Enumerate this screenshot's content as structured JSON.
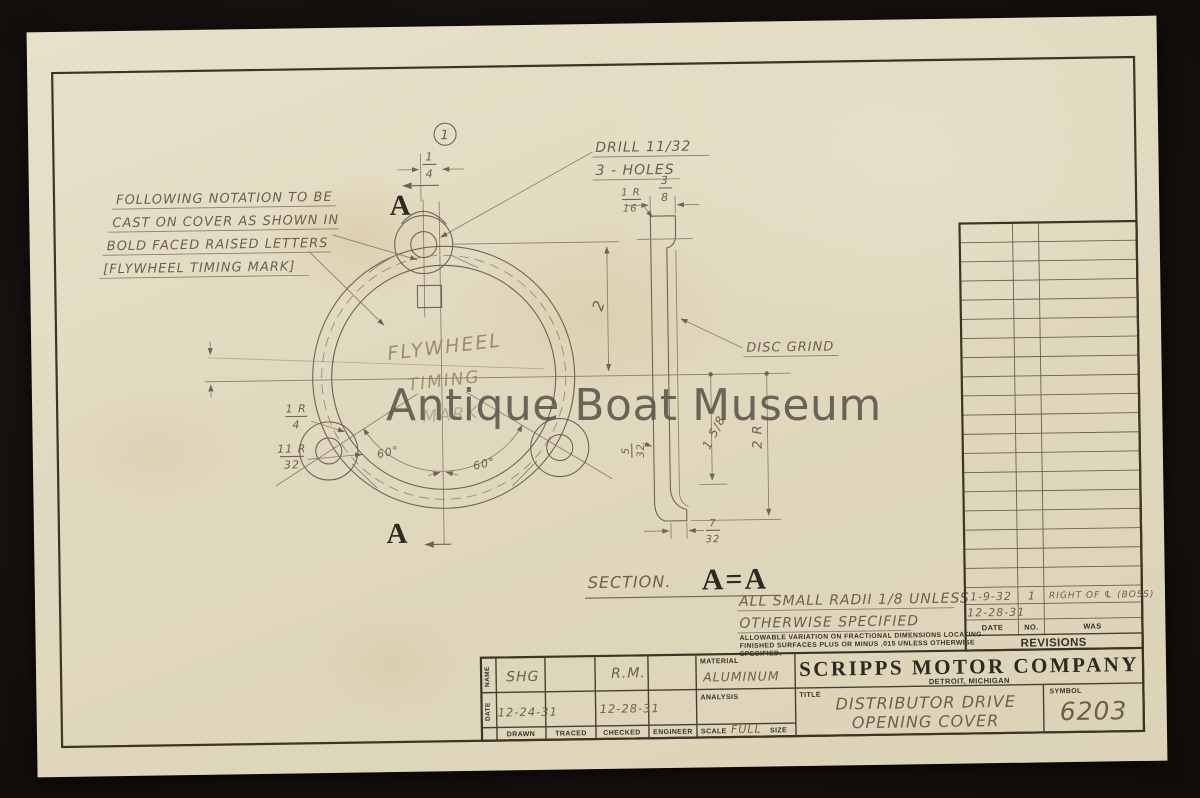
{
  "watermark": {
    "text": "Antique Boat Museum"
  },
  "sheet": {
    "detail_marker": "1",
    "cast_note": {
      "line1": "FOLLOWING NOTATION TO BE",
      "line2": "CAST ON COVER AS SHOWN IN",
      "line3": "BOLD FACED RAISED LETTERS",
      "line4": "[FLYWHEEL TIMING MARK]"
    },
    "drill_note": {
      "line1": "DRILL 11/32",
      "line2": "3 - HOLES"
    },
    "cast_text": {
      "line1": "FLYWHEEL",
      "line2": "TIMING",
      "line3": "MARK"
    },
    "disc_grind": "DISC GRIND",
    "section_arrow_top": "A",
    "section_arrow_bottom": "A",
    "section_label": {
      "prefix": "SECTION.",
      "letters": "A=A"
    },
    "radii_note": {
      "line1": "ALL SMALL RADII 1/8 UNLESS",
      "line2": "OTHERWISE SPECIFIED"
    },
    "variation_note": {
      "line1": "ALLOWABLE VARIATION ON FRACTIONAL DIMENSIONS LOCATING",
      "line2": "FINISHED SURFACES PLUS OR MINUS .015 UNLESS OTHERWISE",
      "line3": "SPECIFIED."
    },
    "dims": {
      "hole_offset": {
        "n": "1",
        "d": "4"
      },
      "center_to_hole": "2",
      "flange_width": {
        "n": "3",
        "d": "8"
      },
      "flange_radius": {
        "n": "1 R",
        "d": "16"
      },
      "lug_fillet_radius": {
        "n": "1 R",
        "d": "4"
      },
      "lug_radius": {
        "n": "11 R",
        "d": "32"
      },
      "wall_thickness": {
        "n": "5",
        "d": "32"
      },
      "foot_width": {
        "n": "7",
        "d": "32"
      },
      "inner_depth": "1 5/8",
      "outer_radius": "2 R",
      "angle_left": "60°",
      "angle_right": "60°"
    }
  },
  "revisions": {
    "title": "REVISIONS",
    "columns": {
      "date": "DATE",
      "no": "NO.",
      "was": "WAS"
    },
    "entries": [
      {
        "date": "1-9-32",
        "no": "1",
        "was": "RIGHT OF ℄ (BOSS)"
      },
      {
        "date": "12-28-31",
        "no": "",
        "was": ""
      }
    ],
    "empty_row_count": 19
  },
  "title_block": {
    "company": "SCRIPPS MOTOR COMPANY",
    "location": "DETROIT, MICHIGAN",
    "labels": {
      "name": "NAME",
      "date": "DATE",
      "drawn": "DRAWN",
      "traced": "TRACED",
      "checked": "CHECKED",
      "engineer": "ENGINEER",
      "material": "MATERIAL",
      "analysis": "ANALYSIS",
      "scale": "SCALE",
      "size": "SIZE",
      "title": "TITLE",
      "symbol": "SYMBOL"
    },
    "values": {
      "drawn_name": "SHG",
      "checked_name": "R.M.",
      "drawn_date": "12-24-31",
      "checked_date": "12-28-31",
      "material": "ALUMINUM",
      "scale": "FULL",
      "title_line1": "DISTRIBUTOR DRIVE",
      "title_line2": "OPENING COVER",
      "symbol": "6203"
    }
  }
}
